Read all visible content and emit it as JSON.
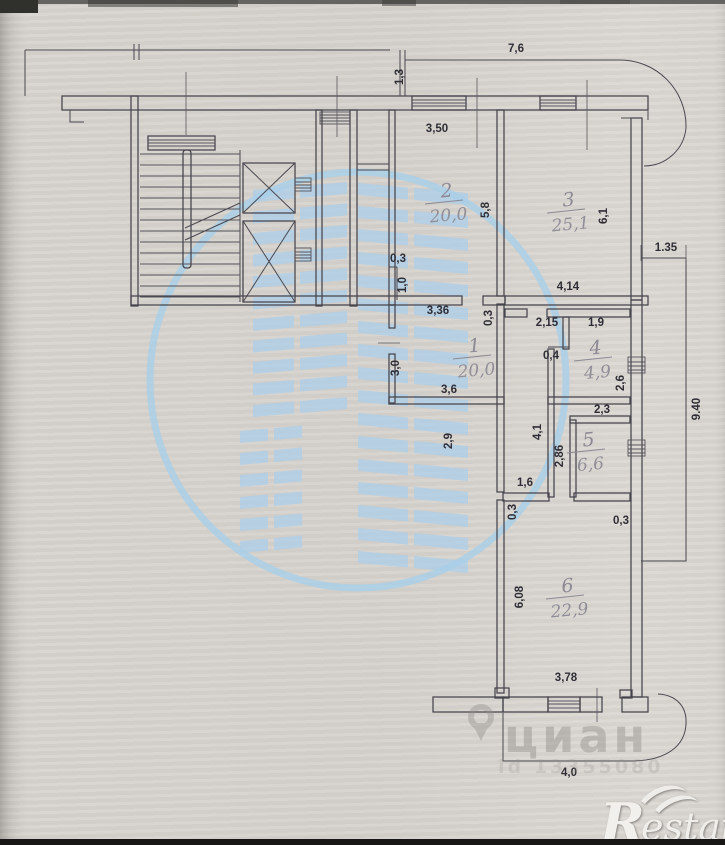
{
  "meta": {
    "title": "apartment floor plan scan"
  },
  "colors": {
    "paper": "#d7d3ce",
    "plan_line": "#45444c",
    "dim_text": "#2f2e36",
    "room_label": "#8b8994",
    "watermark_blue": "#aaceea",
    "watermark_gray": "#8f8c87",
    "logo_white": "#f2f0ec"
  },
  "watermark": {
    "brand": "циан",
    "id_text": "id 13355080",
    "building_icon": "cian-building-icon",
    "ring_icon": "cian-circle-icon"
  },
  "logo": {
    "r": "R",
    "estate": "estate"
  },
  "plan": {
    "room_labels": [
      {
        "num": "2",
        "area": "20,0",
        "x": 447,
        "y": 197
      },
      {
        "num": "3",
        "area": "25,1",
        "x": 569,
        "y": 206
      },
      {
        "num": "1",
        "area": "20,0",
        "x": 475,
        "y": 352
      },
      {
        "num": "4",
        "area": "4,9",
        "x": 596,
        "y": 354
      },
      {
        "num": "5",
        "area": "6,6",
        "x": 589,
        "y": 446
      },
      {
        "num": "6",
        "area": "22,9",
        "x": 568,
        "y": 592
      }
    ],
    "dim_labels": [
      {
        "t": "7,6",
        "x": 516,
        "y": 52,
        "r": 0
      },
      {
        "t": "1,3",
        "x": 403,
        "y": 77,
        "r": -90
      },
      {
        "t": "3,50",
        "x": 437,
        "y": 132,
        "r": 0
      },
      {
        "t": "5,8",
        "x": 489,
        "y": 210,
        "r": -90
      },
      {
        "t": "6,1",
        "x": 607,
        "y": 216,
        "r": -90
      },
      {
        "t": "1.35",
        "x": 666,
        "y": 251,
        "r": 0
      },
      {
        "t": "0,3",
        "x": 398,
        "y": 262,
        "r": 0
      },
      {
        "t": "1,0",
        "x": 406,
        "y": 285,
        "r": -90
      },
      {
        "t": "4,14",
        "x": 568,
        "y": 290,
        "r": 0
      },
      {
        "t": "3,36",
        "x": 438,
        "y": 314,
        "r": 0
      },
      {
        "t": "0,3",
        "x": 492,
        "y": 318,
        "r": -90
      },
      {
        "t": "2,15",
        "x": 547,
        "y": 326,
        "r": 0
      },
      {
        "t": "1,9",
        "x": 596,
        "y": 326,
        "r": 0
      },
      {
        "t": "0,4",
        "x": 551,
        "y": 359,
        "r": 0
      },
      {
        "t": "3,0",
        "x": 399,
        "y": 368,
        "r": -90
      },
      {
        "t": "2,6",
        "x": 624,
        "y": 383,
        "r": -90
      },
      {
        "t": "3,6",
        "x": 449,
        "y": 393,
        "r": 0
      },
      {
        "t": "2,3",
        "x": 602,
        "y": 413,
        "r": 0
      },
      {
        "t": "9.40",
        "x": 700,
        "y": 409,
        "r": -90
      },
      {
        "t": "2,9",
        "x": 452,
        "y": 441,
        "r": -90
      },
      {
        "t": "4,1",
        "x": 541,
        "y": 432,
        "r": -90
      },
      {
        "t": "2,86",
        "x": 563,
        "y": 456,
        "r": -90
      },
      {
        "t": "1,6",
        "x": 525,
        "y": 486,
        "r": 0
      },
      {
        "t": "0,3",
        "x": 516,
        "y": 512,
        "r": -90
      },
      {
        "t": "0,3",
        "x": 621,
        "y": 524,
        "r": 0
      },
      {
        "t": "6,08",
        "x": 523,
        "y": 597,
        "r": -90
      },
      {
        "t": "3,78",
        "x": 566,
        "y": 681,
        "r": 0
      },
      {
        "t": "4,0",
        "x": 569,
        "y": 776,
        "r": 0
      }
    ]
  }
}
